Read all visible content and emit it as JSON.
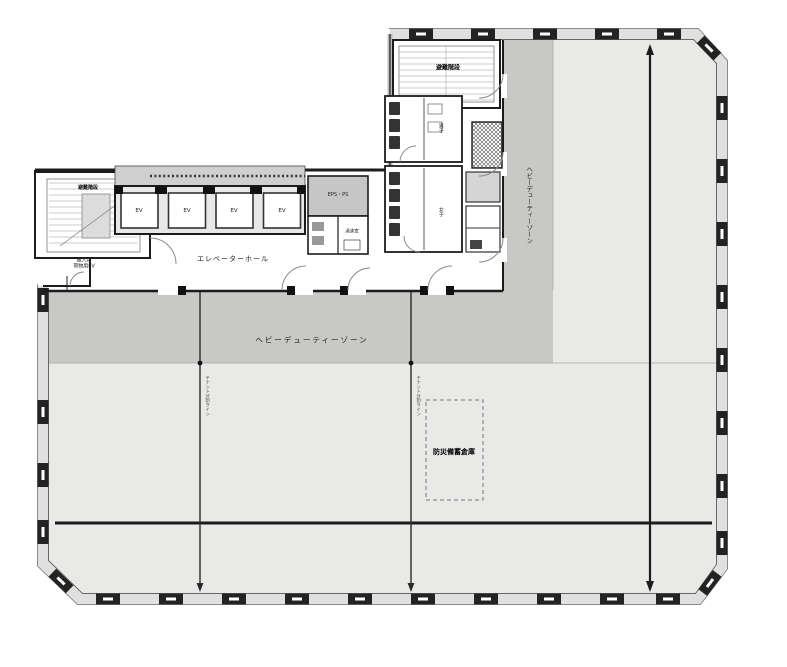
{
  "floor_plan": {
    "core": {
      "elevator_hall": "エレベーターホール",
      "elevators": [
        "EV",
        "EV",
        "EV",
        "EV"
      ],
      "stair_north": "避難階段",
      "stair_west": "避難階段",
      "eps": "EPS・PS",
      "kitchenette": "湯沸室",
      "wc_men": "男子",
      "wc_women": "女子"
    },
    "zones": {
      "heavy_duty_h": "ヘビーデューティーゾーン",
      "heavy_duty_e": "ヘビーデューティーゾーン",
      "storage": "防災備蓄倉庫"
    },
    "annotations": {
      "delivery_1": "搬入用",
      "delivery_2": "荷物用EV",
      "split_w": "テナント分割ライン",
      "split_e": "テナント分割ライン"
    },
    "colors": {
      "office_zone": "#e9e9e8",
      "heavy_duty_zone": "#c8c8c6",
      "wall": "#1c1c1c",
      "column": "#232323",
      "facade_band": "#e0e0e0"
    }
  }
}
